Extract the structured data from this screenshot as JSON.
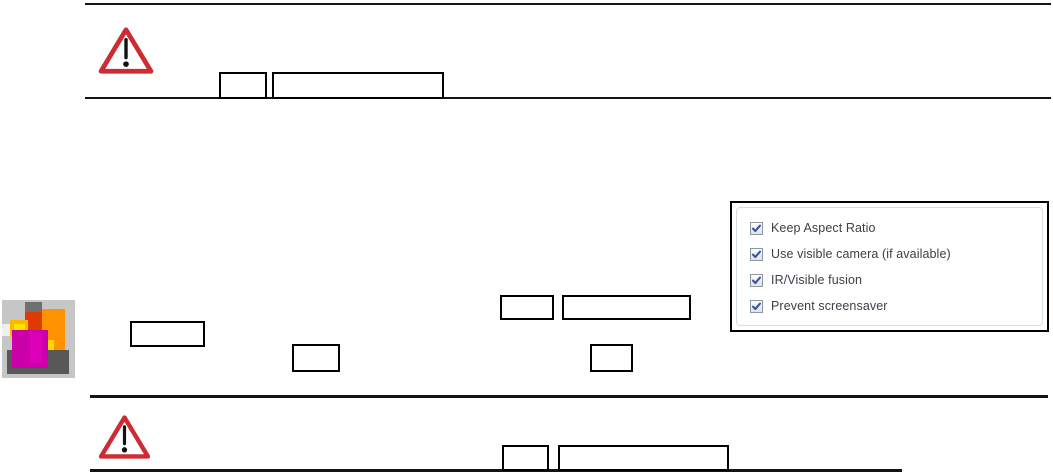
{
  "page": {
    "background": "#ffffff",
    "type": "manual-page"
  },
  "warnings": {
    "top": {
      "icon": "warning-triangle-icon",
      "color": "#ce2b33"
    },
    "bottom": {
      "icon": "warning-triangle-icon",
      "color": "#ce2b33"
    }
  },
  "thermal_thumbnail": {
    "icon": "thermal-image-icon",
    "colors": {
      "background": "#c6c6c6",
      "dark_gray": "#5a5a5a",
      "orange": "#ff9200",
      "yellow": "#ffd800",
      "magenta": "#cb00ab",
      "red": "#dd3c00"
    }
  },
  "options_panel": {
    "border_color": "#000000",
    "inner_border_color": "#d5dee4",
    "check_color": "#3a55a4",
    "items": [
      {
        "label": "Keep Aspect Ratio",
        "checked": true
      },
      {
        "label": "Use visible camera (if available)",
        "checked": true
      },
      {
        "label": "IR/Visible fusion",
        "checked": true
      },
      {
        "label": "Prevent screensaver",
        "checked": true
      }
    ]
  }
}
